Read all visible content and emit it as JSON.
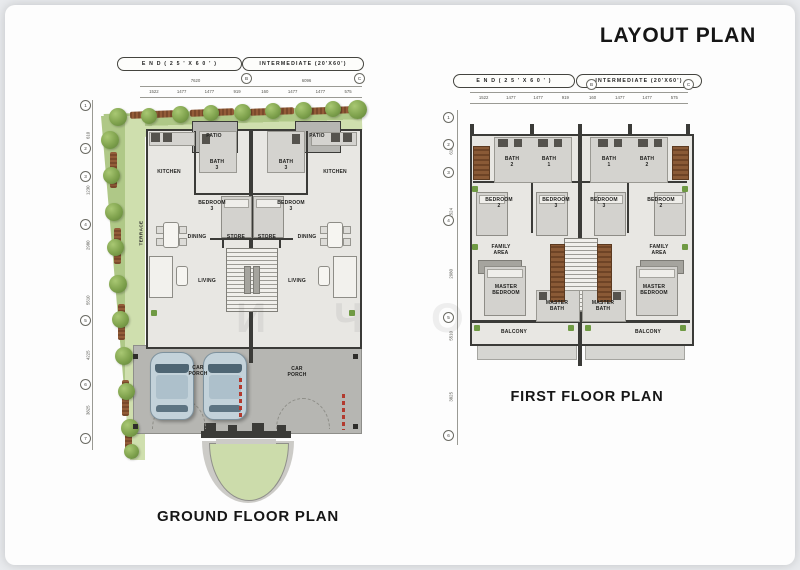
{
  "title": "LAYOUT PLAN",
  "watermark": "И Ч О",
  "ground_plan": {
    "caption": "GROUND FLOOR PLAN",
    "tag_end": "E N D  ( 2 5 ' X 6 0 ' )",
    "tag_intermediate": "INTERMEDIATE (20'X60')",
    "grid_top": [
      "B",
      "C"
    ],
    "grid_left": [
      "1",
      "2",
      "3",
      "4",
      "5",
      "6",
      "7"
    ],
    "dims_overall": [
      "7620",
      "6096"
    ],
    "dims_top": [
      "1522",
      "1477",
      "1477",
      "919",
      "160",
      "1477",
      "1477",
      "575"
    ],
    "dims_left": [
      "610",
      "1230",
      "2980",
      "5510",
      "4225",
      "3825"
    ],
    "rooms": {
      "patio": "PATIO",
      "kitchen": "KITCHEN",
      "bath3": "BATH\n3",
      "bedroom3": "BEDROOM\n3",
      "dining": "DINING",
      "store": "STORE",
      "living": "LIVING",
      "terrace": "TERRACE",
      "car_porch": "CAR\nPORCH"
    }
  },
  "first_plan": {
    "caption": "FIRST FLOOR PLAN",
    "tag_end": "E N D  ( 2 5 ' X 6 0 ' )",
    "tag_intermediate": "INTERMEDIATE (20'X60')",
    "grid_top": [
      "B",
      "C"
    ],
    "grid_left": [
      "1",
      "2",
      "3",
      "4",
      "5",
      "6"
    ],
    "dims_overall": [
      "7620",
      "6096"
    ],
    "dims_top": [
      "1522",
      "1477",
      "1477",
      "919",
      "160",
      "1477",
      "1477",
      "575"
    ],
    "dims_left": [
      "610",
      "1524",
      "2980",
      "5510",
      "3825"
    ],
    "rooms": {
      "bath1": "BATH\n1",
      "bath2": "BATH\n2",
      "bedroom2": "BEDROOM\n2",
      "bedroom3": "BEDROOM\n3",
      "family": "FAMILY\nAREA",
      "master_bedroom": "MASTER\nBEDROOM",
      "master_bath": "MASTER\nBATH",
      "balcony": "BALCONY"
    }
  }
}
